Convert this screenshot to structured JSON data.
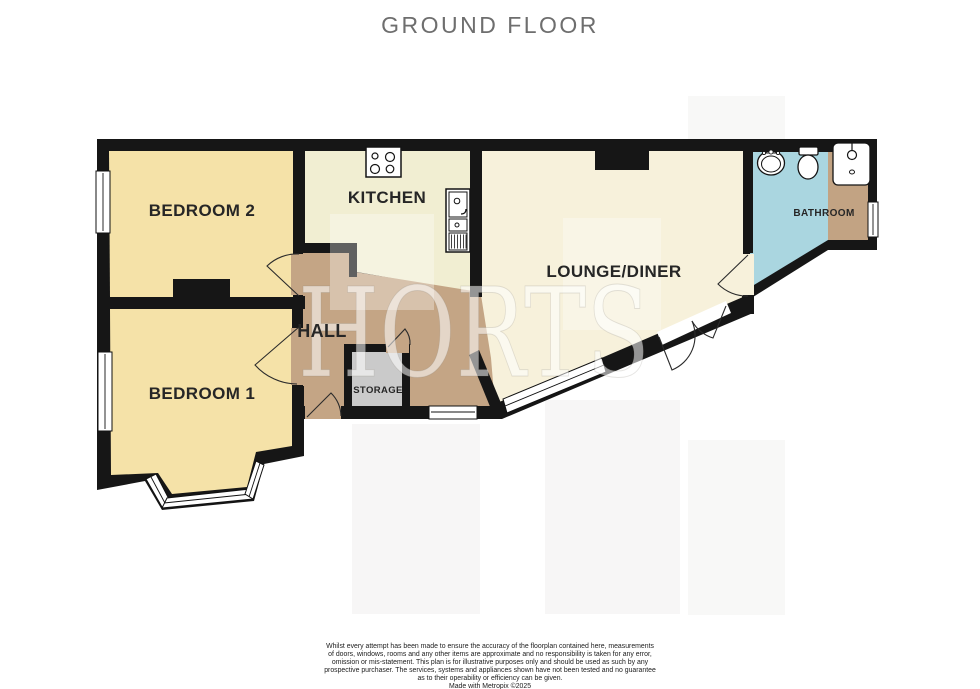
{
  "header": {
    "title": "GROUND FLOOR"
  },
  "watermark": {
    "text": "HORTS"
  },
  "rooms": {
    "bedroom2": {
      "label": "BEDROOM 2"
    },
    "kitchen": {
      "label": "KITCHEN"
    },
    "lounge_diner": {
      "label": "LOUNGE/DINER"
    },
    "bathroom": {
      "label": "BATHROOM"
    },
    "hall": {
      "label": "HALL"
    },
    "bedroom1": {
      "label": "BEDROOM 1"
    },
    "storage": {
      "label": "STORAGE"
    }
  },
  "fixtures": {
    "kitchen": [
      "hob-icon",
      "sink-unit-icon"
    ],
    "bathroom": [
      "washbasin-icon",
      "toilet-icon",
      "shower-icon"
    ]
  },
  "colors": {
    "wall": "#161616",
    "bedroom": "#F5E2A8",
    "kitchen": "#F1EED2",
    "lounge": "#F7F1DB",
    "hall": "#C4A585",
    "bathroom": "#AAD6E0",
    "bathroom_cupboard": "#C2A383",
    "storage": "#CACACA",
    "window": "#FFFFFF",
    "exterior": "#FFFFFF",
    "label": "#262626",
    "title": "#6E6E6E"
  },
  "footer": {
    "lines": [
      "Whilst every attempt has been made to ensure the accuracy of the floorplan contained here, measurements",
      "of doors, windows, rooms and any other items are approximate and no responsibility is taken for any error,",
      "omission or mis-statement. This plan is for illustrative purposes only and should be used as such by any",
      "prospective purchaser. The services, systems and appliances shown have not been tested and no guarantee",
      "as to their operability or efficiency can be given.",
      "Made with Metropix ©2025"
    ]
  }
}
